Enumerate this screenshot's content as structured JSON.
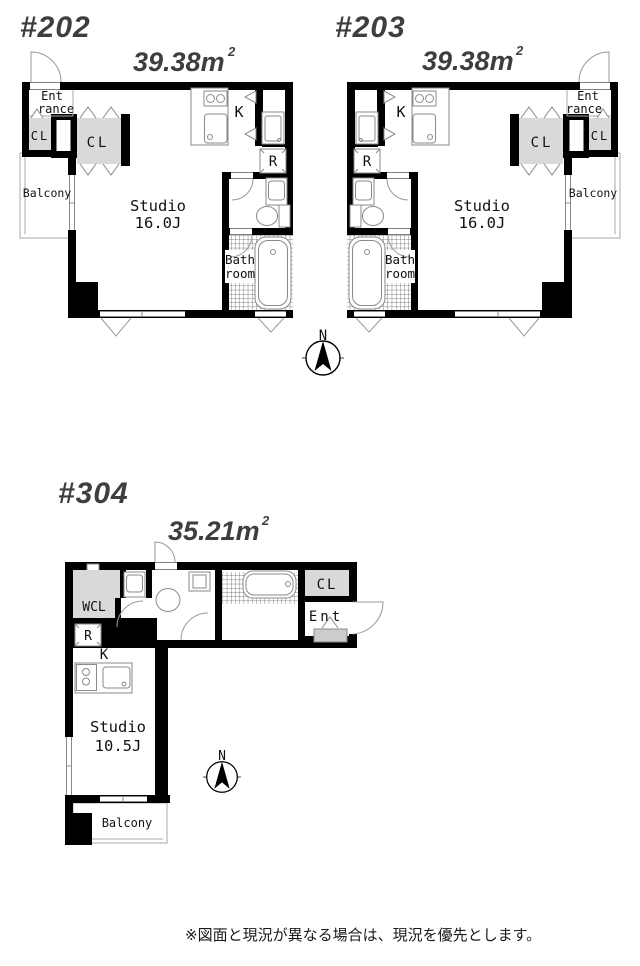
{
  "units": {
    "u202": {
      "title": "#202",
      "area_main": "39.38m",
      "area_sup": "2",
      "labels": {
        "entrance_1": "Ent",
        "entrance_2": "rance",
        "closet_a": "CL",
        "closet_b": "CL",
        "balcony": "Balcony",
        "studio": "Studio",
        "studio_size": "16.0J",
        "kitchen": "K",
        "refrigerator": "R",
        "bath_1": "Bath",
        "bath_2": "room"
      }
    },
    "u203": {
      "title": "#203",
      "area_main": "39.38m",
      "area_sup": "2",
      "labels": {
        "entrance_1": "Ent",
        "entrance_2": "rance",
        "closet_a": "CL",
        "closet_b": "CL",
        "balcony": "Balcony",
        "studio": "Studio",
        "studio_size": "16.0J",
        "kitchen": "K",
        "refrigerator": "R",
        "bath_1": "Bath",
        "bath_2": "room"
      }
    },
    "u304": {
      "title": "#304",
      "area_main": "35.21m",
      "area_sup": "2",
      "labels": {
        "walk_in_closet": "WCL",
        "refrigerator": "R",
        "kitchen": "K",
        "closet": "CL",
        "entrance": "Ent",
        "studio": "Studio",
        "studio_size": "10.5J",
        "balcony": "Balcony"
      }
    }
  },
  "compass": {
    "north": "N"
  },
  "footer": {
    "note": "※図面と現況が異なる場合は、現況を優先とします。"
  }
}
